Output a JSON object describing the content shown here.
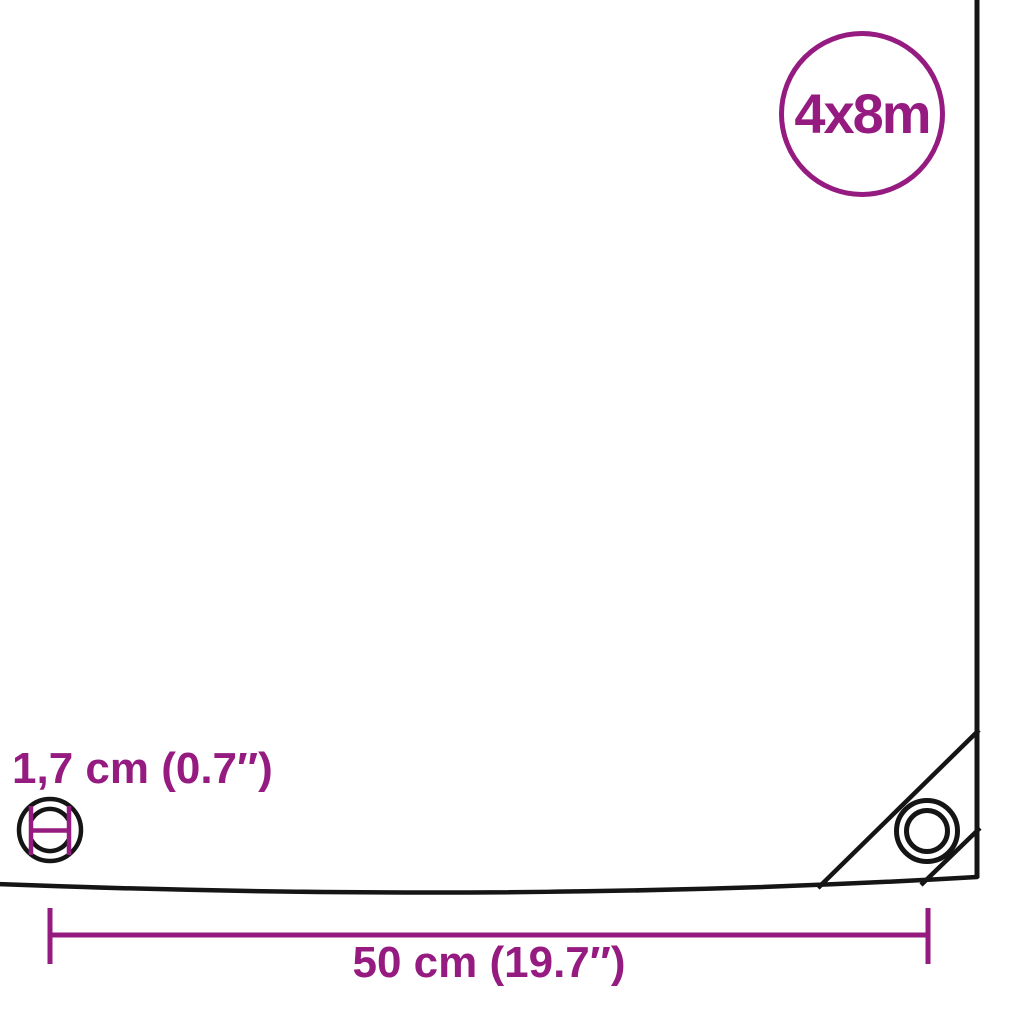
{
  "diagram": {
    "badge": {
      "label": "4x8m"
    },
    "labels": {
      "eyelet_diameter": "1,7 cm (0.7″)",
      "eyelet_spacing": "50 cm (19.7″)"
    },
    "colors": {
      "accent": "#951b81",
      "line": "#151515",
      "background": "#ffffff"
    },
    "icons": {
      "eyelet_detail": "eyelet-thickness-icon",
      "corner_eyelet": "corner-eyelet-icon"
    }
  }
}
